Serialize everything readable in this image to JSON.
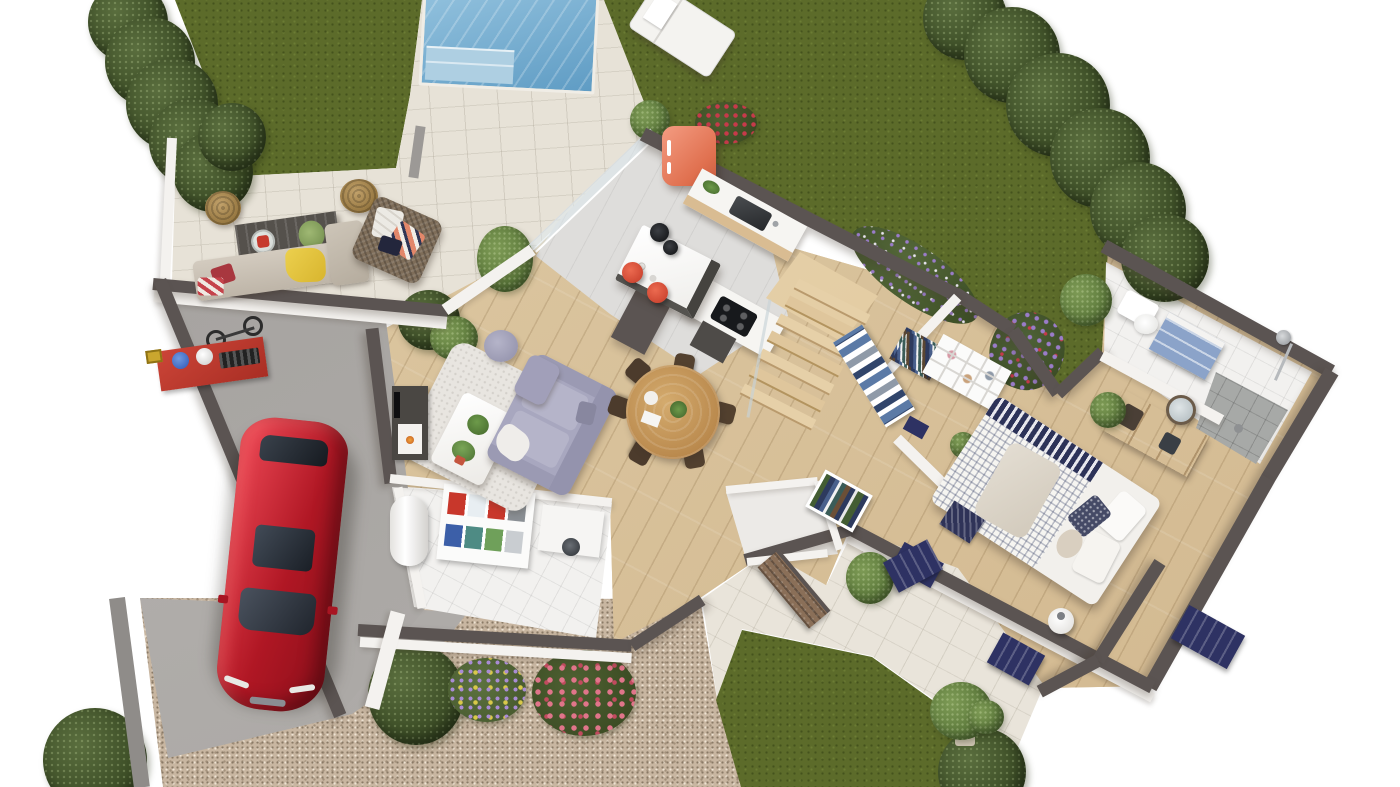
{
  "scene": {
    "type": "3d-floor-plan",
    "view": "isometric top-down render, ground floor of a modern house with garden",
    "background_color": "#ffffff"
  },
  "palette": {
    "grass": "#5c6b2a",
    "hedge": "#3c4d26",
    "pool_water": "#6fa9cf",
    "pool_steps": "#aecfe2",
    "paving": "#e7e2d7",
    "wood_floor": "#dbc49e",
    "kitchen_floor": "#dedddb",
    "garage_concrete": "#a8a5a2",
    "gravel": "#c8b6a1",
    "wall_cut": "#5b5452",
    "wall_white": "#f4f2ef",
    "fridge_coral": "#e8826a",
    "car_red": "#c01c2a",
    "stool_red": "#d94a36",
    "sofa_lavender": "#a8a7bf",
    "vanity_blue": "#8ba3c9",
    "shutter_navy": "#2e3263",
    "stone_wall": "#8a6f58",
    "dining_wood": "#c99f63"
  },
  "outdoor": {
    "lawns": [
      "front lawn top-left",
      "large back garden lawn top-right",
      "south lawn wedge"
    ],
    "hedges": [
      "west hedge row",
      "north-east tree row",
      "driveway corner bush",
      "south tree"
    ],
    "pool": {
      "label": "swimming pool",
      "water_color": "#6fa9cf",
      "has_steps": true
    },
    "sun_lounger": {
      "label": "double sun lounger with towel",
      "color": "#f4f3f0"
    },
    "patio": {
      "label": "outdoor lounge patio",
      "items": [
        "rattan pouf",
        "rattan pouf",
        "slatted outdoor coffee table with red tray",
        "beige outdoor sofa with red cushions and yellow throw",
        "rattan armchair with orange and navy cushions",
        "banana plant"
      ]
    },
    "driveway": {
      "surface": "gravel",
      "apron": "concrete",
      "edge_wall": true
    },
    "flower_beds": [
      "green shrub",
      "lavender and yellow flowers",
      "pink rose bush",
      "red roses by kitchen",
      "wildflower border",
      "purple flower patch in garden notch"
    ],
    "terrace": {
      "items": [
        "monstera plant in pot",
        "navy window shutter",
        "navy window shutter",
        "navy window shutter"
      ]
    },
    "car": {
      "label": "red coupe parked in garage",
      "color": "#c01c2a"
    }
  },
  "rooms": [
    {
      "id": "garage",
      "name": "Garage",
      "floor": "concrete",
      "items": [
        "red coupe",
        "wall-mounted bicycle",
        "red workbench with buckets and tools"
      ]
    },
    {
      "id": "utility",
      "name": "Utility room",
      "floor": "white tile",
      "items": [
        "cylindrical water heater",
        "shelving with coloured storage boxes",
        "counter with washer"
      ]
    },
    {
      "id": "living",
      "name": "Living room",
      "floor": "oak",
      "items": [
        "lavender corner sofa",
        "white coffee table with plants",
        "shaggy rug",
        "lavender pouf",
        "tv unit with fireplace",
        "palm plant"
      ]
    },
    {
      "id": "kitchen",
      "name": "Kitchen",
      "floor": "grey stone",
      "items": [
        "coral retro fridge",
        "island with 2 red bar stools",
        "2 black pendant lamps",
        "sink counter",
        "induction hob counter"
      ]
    },
    {
      "id": "dining",
      "name": "Dining area",
      "floor": "oak",
      "items": [
        "round wooden table",
        "6 dark wood chairs"
      ]
    },
    {
      "id": "stairs",
      "name": "Staircase",
      "material": "light oak, winder with landing"
    },
    {
      "id": "hall",
      "name": "Entrance hall",
      "items": [
        "open wardrobe with hanging clothes",
        "stone accent wall",
        "navy doormat",
        "fern"
      ]
    },
    {
      "id": "wc",
      "name": "Guest WC",
      "floor": "pale tile"
    },
    {
      "id": "dressing",
      "name": "Dressing room",
      "items": [
        "white shelving with folded clothes",
        "hanging rail",
        "cubby unit",
        "navy stack"
      ]
    },
    {
      "id": "bathroom",
      "name": "Bathroom",
      "items": [
        "toilet",
        "blue vanity unit",
        "walk-in shower with grey tiles",
        "shower column"
      ]
    },
    {
      "id": "bedroom",
      "name": "Bedroom",
      "items": [
        "double bed with navy check duvet",
        "wooden sideboard",
        "round mirror",
        "plant",
        "white bedside table",
        "navy textured throw"
      ]
    }
  ]
}
